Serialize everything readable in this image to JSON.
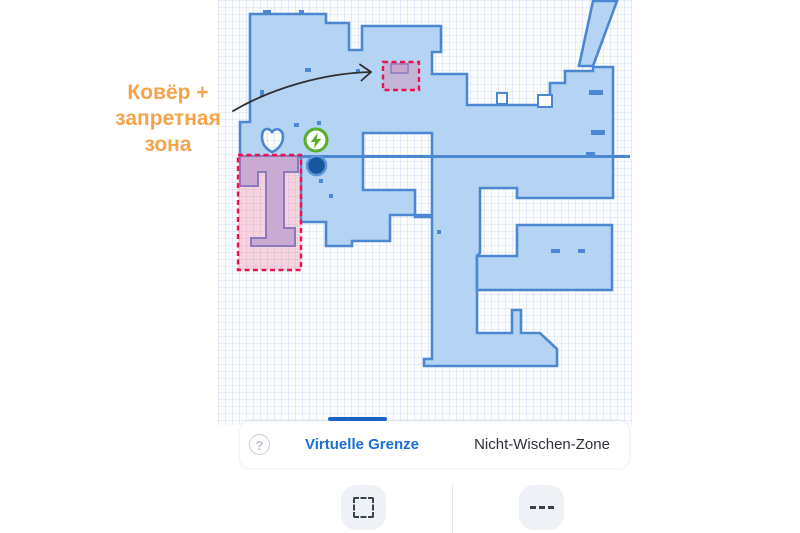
{
  "annotation": {
    "text": "Ковёр + запретная зона",
    "color": "#F6A44C"
  },
  "map": {
    "colors": {
      "floor": "#B5D4F3",
      "wall": "#4C87D2",
      "partial_floor": "#BCC6EC",
      "partial_wall": "#6B85D0",
      "zone_border": "#E8134F",
      "zone_fill": "rgba(236,93,135,0.26)",
      "charger_green": "#56B02C",
      "robot_blue": "#16579F",
      "grid_line": "#E3EAF4"
    },
    "markers": {
      "charger": "charger-lightning-icon",
      "robot": "robot-position-marker"
    },
    "zones": [
      {
        "name": "no-go-zone-carpet",
        "type": "virtual-no-go"
      },
      {
        "name": "no-go-zone-left-room",
        "type": "virtual-no-go"
      }
    ]
  },
  "bottom_sheet": {
    "help_label": "?",
    "tabs": [
      {
        "label": "Virtuelle Grenze",
        "active": true,
        "color": "#1A6ED8"
      },
      {
        "label": "Nicht-Wischen-Zone",
        "active": false,
        "color": "#2D3137"
      }
    ]
  },
  "toolbar": {
    "buttons": [
      {
        "name": "add-rectangle-zone-button",
        "icon": "dashed-rectangle-icon"
      },
      {
        "name": "add-line-boundary-button",
        "icon": "dashed-line-icon"
      }
    ]
  }
}
